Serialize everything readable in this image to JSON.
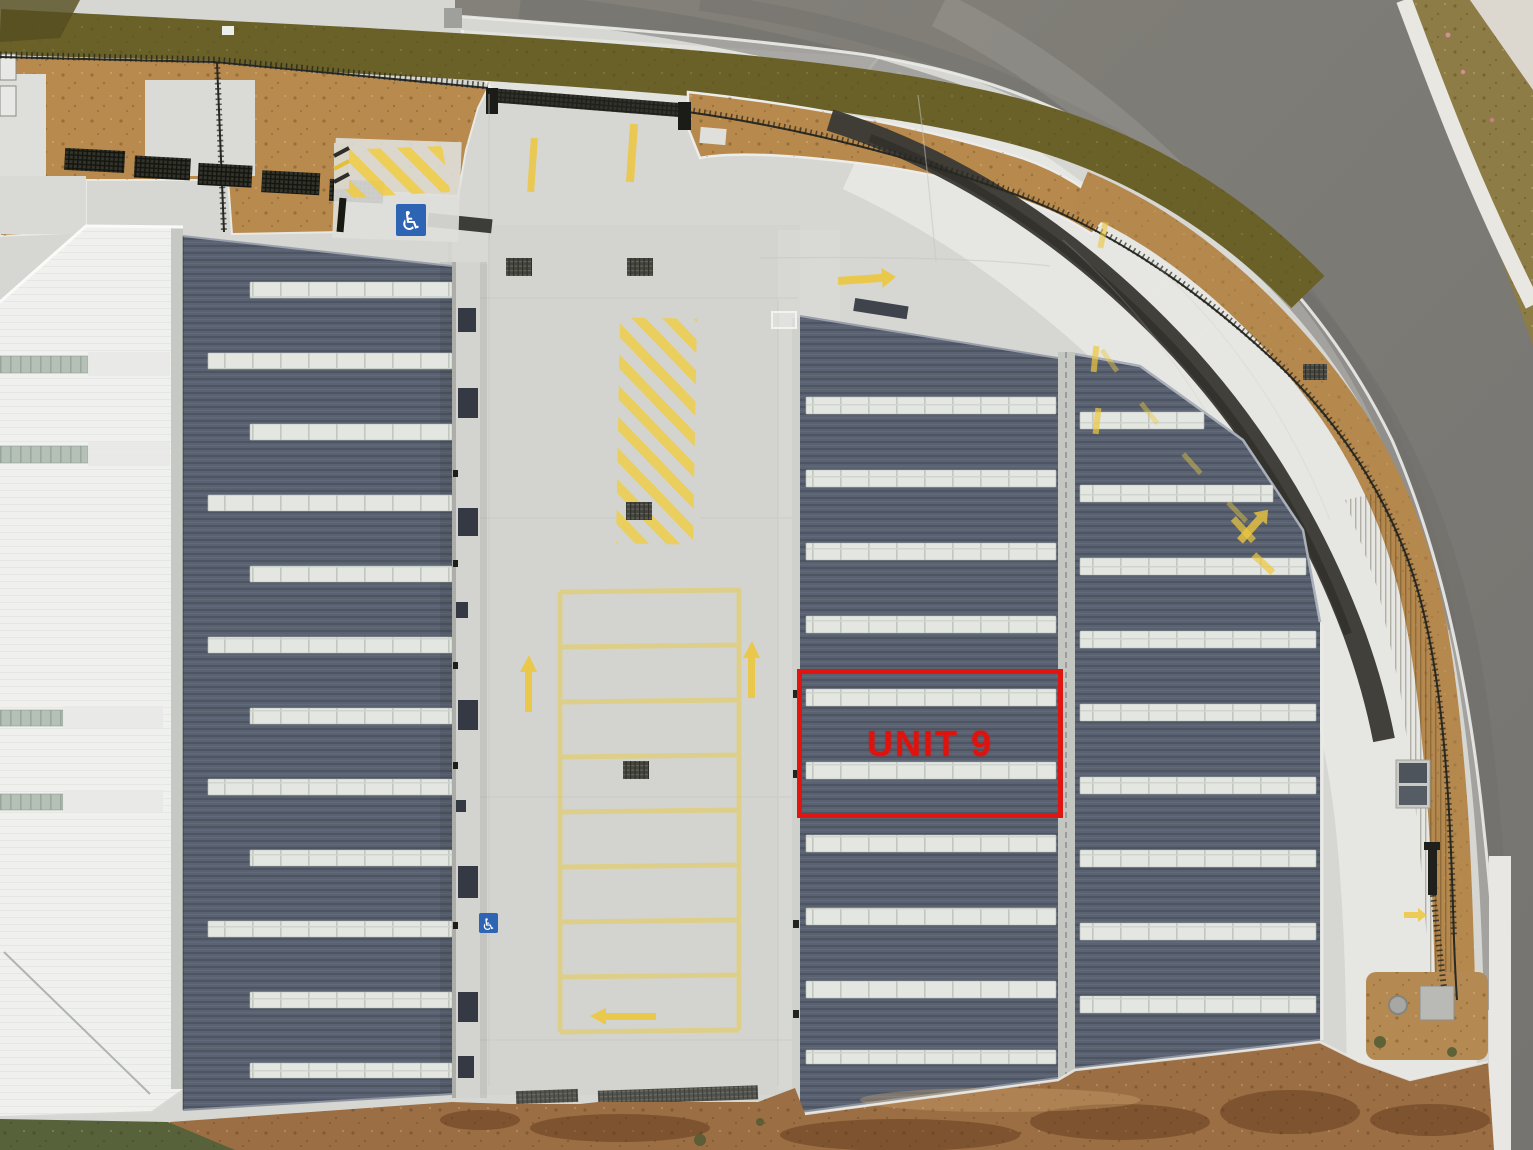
{
  "annotation": {
    "label": "UNIT 9",
    "box_color": "#e1150f",
    "text_color": "#df120d"
  },
  "icons": {
    "wheelchair": {
      "glyph": "♿",
      "background": "#2d64b4",
      "color": "#ffffff"
    }
  },
  "palette": {
    "concrete": "#d6d7d3",
    "concrete_bright": "#e6e6e2",
    "asphalt_road": "#7b7976",
    "asphalt_fresh": "#3c3a36",
    "roof_dark": "#5a6170",
    "roof_skylight": "#e3e6e1",
    "white_roof": "#f0f1ee",
    "mulch": "#b8894c",
    "dry_grass": "#6a6129",
    "dirt": "#9c6e44",
    "grass": "#57613a",
    "marking_yellow": "#ecc73d",
    "fence": "#26261f"
  }
}
